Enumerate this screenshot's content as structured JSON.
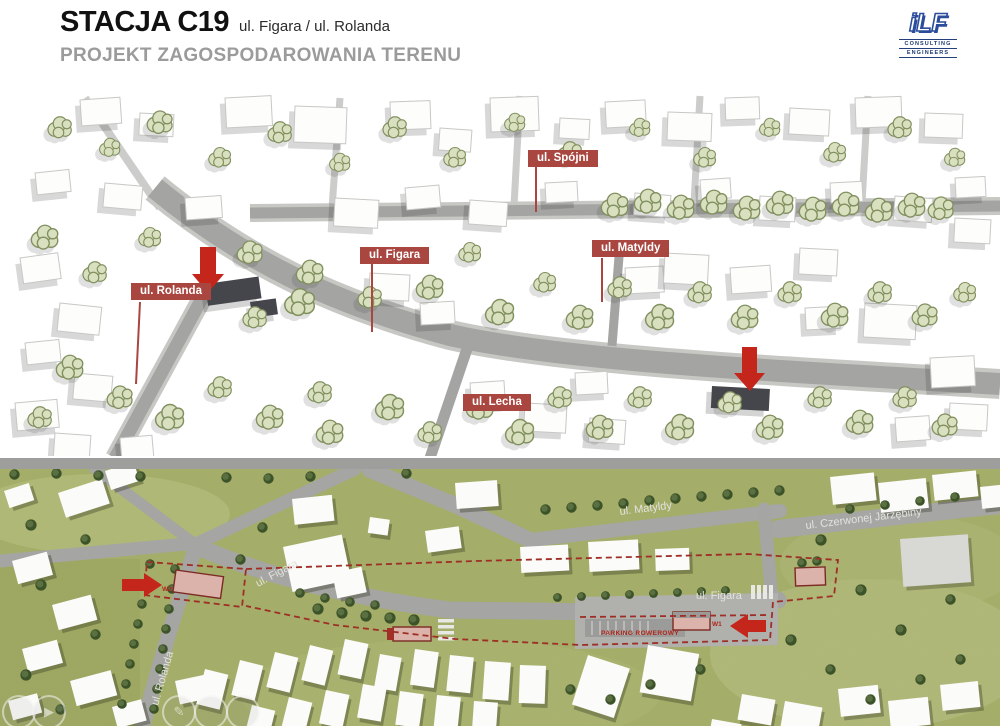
{
  "header": {
    "title": "STACJA C19",
    "title_suffix": "ul. Figara / ul. Rolanda",
    "subtitle": "PROJEKT ZAGOSPODAROWANIA TERENU"
  },
  "logo": {
    "mark": "iLF",
    "caption_line1": "CONSULTING",
    "caption_line2": "ENGINEERS"
  },
  "view_3d": {
    "street_labels": [
      {
        "id": "rolanda",
        "text": "ul. Rolanda"
      },
      {
        "id": "figara",
        "text": "ul. Figara"
      },
      {
        "id": "spojni",
        "text": "ul. Spójni"
      },
      {
        "id": "matyldy",
        "text": "ul. Matyldy"
      },
      {
        "id": "lecha",
        "text": "ul. Lecha"
      }
    ]
  },
  "site_plan": {
    "street_names": [
      {
        "id": "matyldy",
        "text": "ul. Matyldy"
      },
      {
        "id": "czerwonej",
        "text": "ul. Czerwonej Jarzębiny"
      },
      {
        "id": "figara_west",
        "text": "ul. Figara"
      },
      {
        "id": "figara_east",
        "text": "ul. Figara"
      },
      {
        "id": "rolanda",
        "text": "ul. Rolanda"
      }
    ],
    "annotations": [
      {
        "id": "parking",
        "text": "PARKING ROWEROWY"
      },
      {
        "id": "w2",
        "text": "W2"
      },
      {
        "id": "w1",
        "text": "W1"
      }
    ]
  },
  "colors": {
    "label_red": "#a8463f",
    "arrow_red": "#c5261b",
    "boundary_red": "#9e2f26",
    "entrance_pink": "#dcb3aa",
    "tree_light": "#d9e0c0",
    "tree_dark": "#3c5229",
    "grass": "#a6af6a",
    "road_gray": "#a5a5a3",
    "logo_blue": "#2b4d9b",
    "subtitle_gray": "#9b9b9b"
  }
}
